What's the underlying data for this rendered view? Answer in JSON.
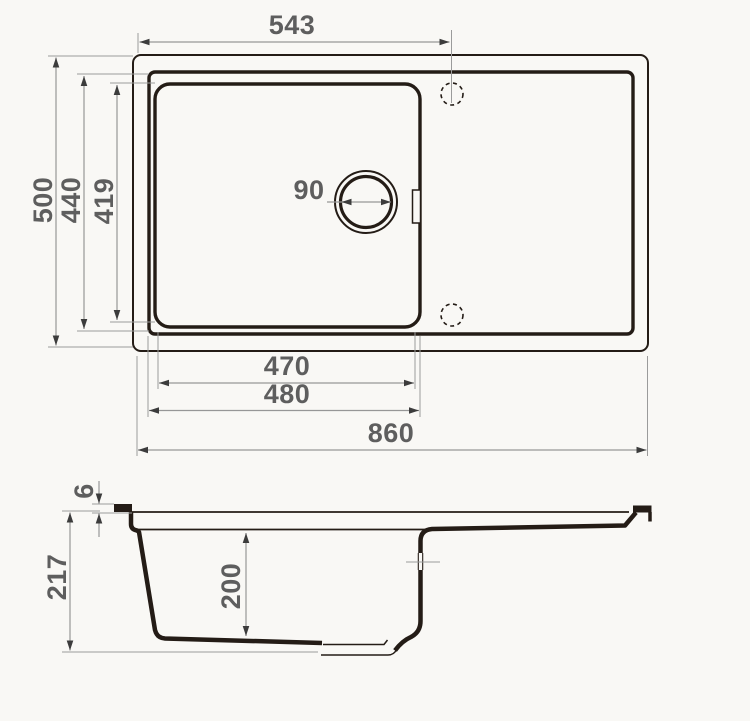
{
  "drawing": {
    "title": "Kitchen sink technical dimension drawing",
    "views": [
      "top-view",
      "side-section-view"
    ],
    "units": "mm",
    "colors": {
      "background": "#f9f8f5",
      "sink_outline": "#241c16",
      "dimension_line": "#979797",
      "arrow": "#3c3c3c",
      "label_text": "#5e5e5e"
    },
    "top_view": {
      "faucet_offset": "543",
      "overall_depth": "500",
      "rim_opening_depth": "440",
      "bowl_front_to_back": "419",
      "drain_diameter": "90",
      "bowl_inner_width": "470",
      "bowl_outer_width": "480",
      "overall_width": "860"
    },
    "side_view": {
      "rim_thickness": "6",
      "overall_height": "217",
      "bowl_depth": "200"
    }
  }
}
